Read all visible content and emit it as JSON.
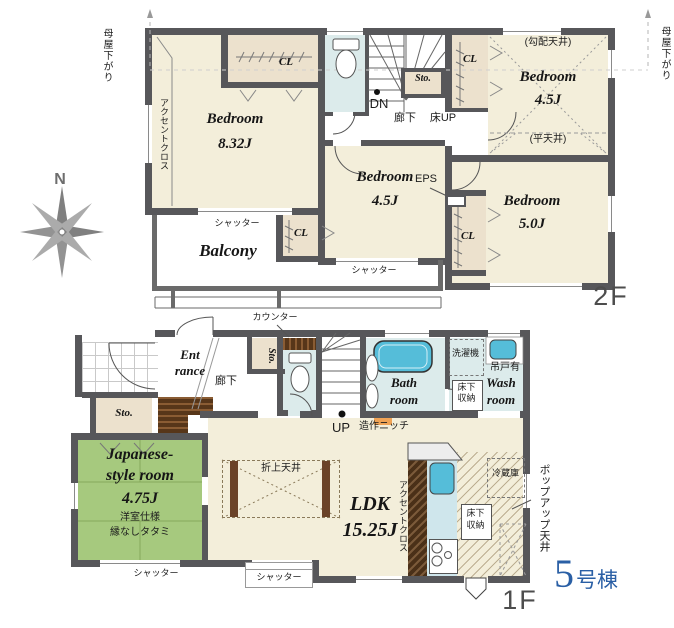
{
  "compass": {
    "north": "N"
  },
  "unit_badge": {
    "number": "5",
    "suffix": "号棟",
    "color": "#2a5fa5"
  },
  "floor2": {
    "floor_label": "2F",
    "roof_note": "母屋下がり",
    "accent_cloth": "アクセントクロス",
    "shutter": "シャッター",
    "closet": "CL",
    "storage": "Sto.",
    "hallway": "廊下",
    "stairs_down": "DN",
    "floor_hatch_up": "床UP",
    "eps": "EPS",
    "bedroom_main": {
      "name": "Bedroom",
      "size": "8.32J"
    },
    "bedroom_ne": {
      "name": "Bedroom",
      "size": "4.5J",
      "sloped_ceiling": "(勾配天井)",
      "flat_ceiling": "(平天井)"
    },
    "bedroom_mid": {
      "name": "Bedroom",
      "size": "4.5J"
    },
    "bedroom_se": {
      "name": "Bedroom",
      "size": "5.0J"
    },
    "balcony": "Balcony"
  },
  "floor1": {
    "floor_label": "1F",
    "entrance": {
      "line1": "Ent",
      "line2": "rance"
    },
    "hallway": "廊下",
    "storage": "Sto.",
    "counter": "カウンター",
    "stairs_up": "UP",
    "niche": "造作ニッチ",
    "bath": {
      "line1": "Bath",
      "line2": "room"
    },
    "wash": {
      "line1": "Wash",
      "line2": "room"
    },
    "washing_machine": "洗濯機",
    "hanging_cupboard": "吊戸有",
    "underfloor": {
      "line1": "床下",
      "line2": "収納"
    },
    "ldk": {
      "name": "LDK",
      "size": "15.25J"
    },
    "coffered_ceiling": "折上天井",
    "accent_cloth": "アクセントクロス",
    "popup_ceiling": "ポップアップ天井",
    "refrigerator": "冷蔵庫",
    "japanese_room": {
      "line1": "Japanese-",
      "line2": "style room",
      "size": "4.75J",
      "note1": "洋室仕様",
      "note2": "縁なしタタミ"
    },
    "shutter": "シャッター"
  }
}
